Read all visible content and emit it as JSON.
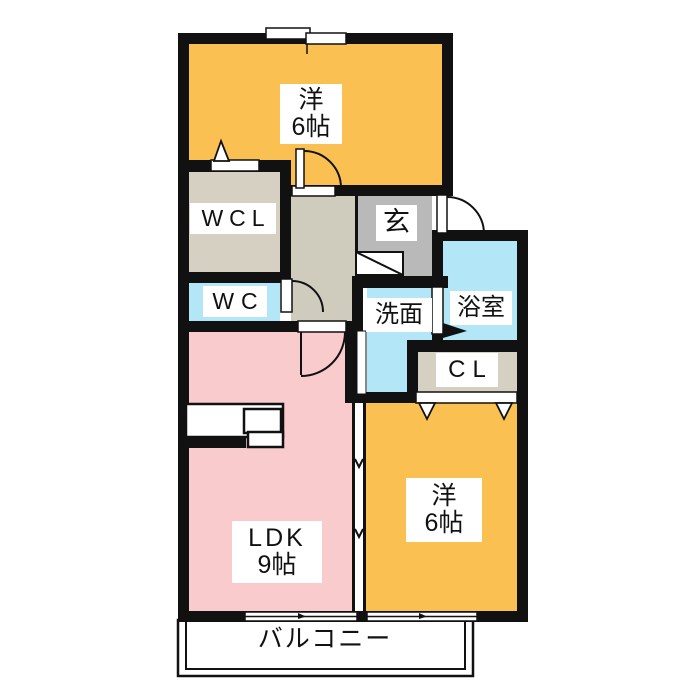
{
  "title": "apartment-floor-plan",
  "colors": {
    "wall": "#111111",
    "room_yellow": "#FAC152",
    "room_pink": "#F9CBCD",
    "room_blue": "#B3E7F8",
    "room_beige": "#D5D0C2",
    "hall_beige": "#CFCCBE",
    "entrance_gray": "#B9B9B9",
    "label_bg": "#FFFFFF"
  },
  "rooms": {
    "bedroom_top": {
      "line1": "洋",
      "line2": "6帖"
    },
    "wcl": {
      "label": "WCL"
    },
    "wc": {
      "label": "WC"
    },
    "entrance": {
      "label": "玄"
    },
    "bath": {
      "label": "浴室"
    },
    "washroom": {
      "label": "洗面"
    },
    "closet": {
      "label": "CL"
    },
    "ldk": {
      "line1": "LDK",
      "line2": "9帖"
    },
    "bedroom_bottom": {
      "line1": "洋",
      "line2": "6帖"
    },
    "balcony": {
      "label": "バルコニー"
    }
  }
}
